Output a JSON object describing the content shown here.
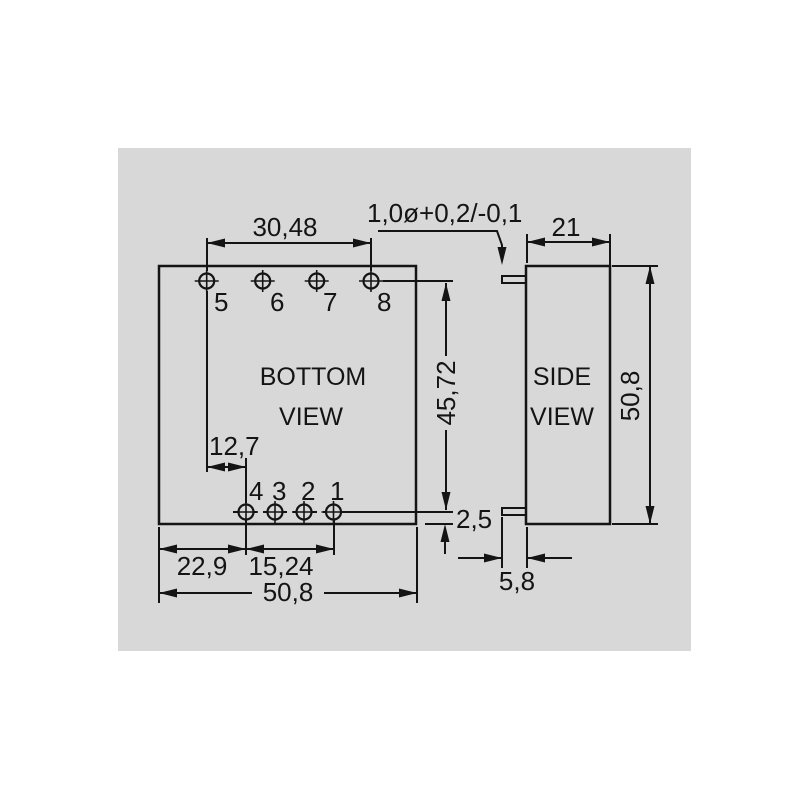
{
  "drawing": {
    "type": "mechanical-dimension-drawing",
    "views": {
      "bottom": {
        "title_line1": "BOTTOM",
        "title_line2": "VIEW",
        "pins_top": [
          "5",
          "6",
          "7",
          "8"
        ],
        "pins_bottom": [
          "4",
          "3",
          "2",
          "1"
        ]
      },
      "side": {
        "title_line1": "SIDE",
        "title_line2": "VIEW"
      }
    },
    "dimensions": {
      "pin_span_top": "30,48",
      "pin_diameter_tolerance": "1,0ø+0,2/-0,1",
      "side_width": "21",
      "pin_rows_gap": "45,72",
      "pin_row_to_edge": "2,5",
      "side_height": "50,8",
      "pin_offset": "12,7",
      "edge_to_pin4": "22,9",
      "pin_span_bottom": "15,24",
      "body_width": "50,8",
      "pin_protrusion": "5,8"
    },
    "colors": {
      "background": "#ffffff",
      "panel": "#d8d8d8",
      "line": "#141414"
    }
  }
}
